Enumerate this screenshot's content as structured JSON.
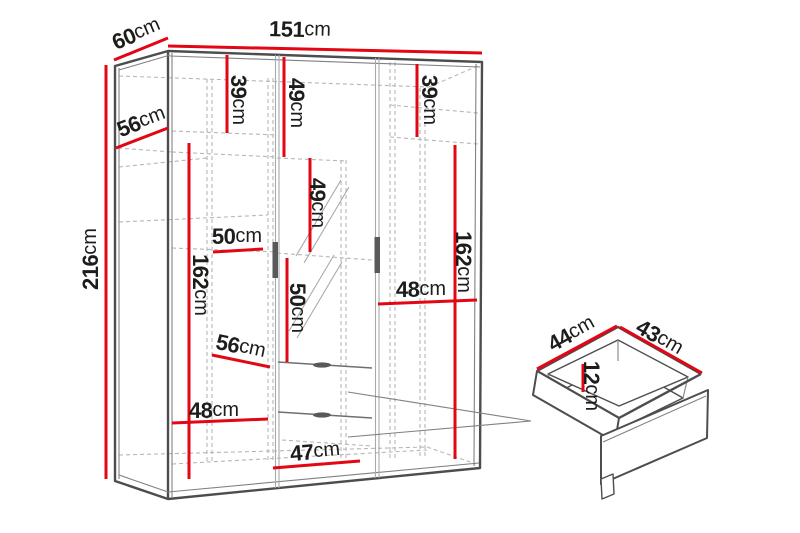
{
  "page": {
    "type": "furniture dimension diagram",
    "background": "#ffffff"
  },
  "colors": {
    "dimension_line": "#e30613",
    "outline": "#4d4d4f",
    "secondary_line": "#808184",
    "dashed_line": "#b4b6b8",
    "label_text": "#1d1d1b",
    "background": "#ffffff"
  },
  "wardrobe": {
    "dimensions": [
      {
        "id": "overall_width",
        "num": "151",
        "unit": "cm"
      },
      {
        "id": "overall_depth",
        "num": "60",
        "unit": "cm"
      },
      {
        "id": "overall_height",
        "num": "216",
        "unit": "cm"
      },
      {
        "id": "top_left_shelf_depth",
        "num": "56",
        "unit": "cm"
      },
      {
        "id": "left_top_section_height",
        "num": "39",
        "unit": "cm"
      },
      {
        "id": "center_top_section_height",
        "num": "49",
        "unit": "cm"
      },
      {
        "id": "right_top_section_height",
        "num": "39",
        "unit": "cm"
      },
      {
        "id": "center_middle_section_height",
        "num": "49",
        "unit": "cm"
      },
      {
        "id": "left_shelf_width",
        "num": "50",
        "unit": "cm"
      },
      {
        "id": "left_hanging_section_height",
        "num": "162",
        "unit": "cm"
      },
      {
        "id": "center_mirror_section_height",
        "num": "50",
        "unit": "cm"
      },
      {
        "id": "right_shelf_width",
        "num": "48",
        "unit": "cm"
      },
      {
        "id": "right_hanging_section_height",
        "num": "162",
        "unit": "cm"
      },
      {
        "id": "middle_shelf_depth",
        "num": "56",
        "unit": "cm"
      },
      {
        "id": "bottom_left_shelf_width",
        "num": "48",
        "unit": "cm"
      },
      {
        "id": "bottom_drawer_width",
        "num": "47",
        "unit": "cm"
      }
    ]
  },
  "drawer": {
    "dimensions": [
      {
        "id": "drawer_depth",
        "num": "44",
        "unit": "cm"
      },
      {
        "id": "drawer_width",
        "num": "43",
        "unit": "cm"
      },
      {
        "id": "drawer_inner_height",
        "num": "12",
        "unit": "cm"
      }
    ]
  }
}
